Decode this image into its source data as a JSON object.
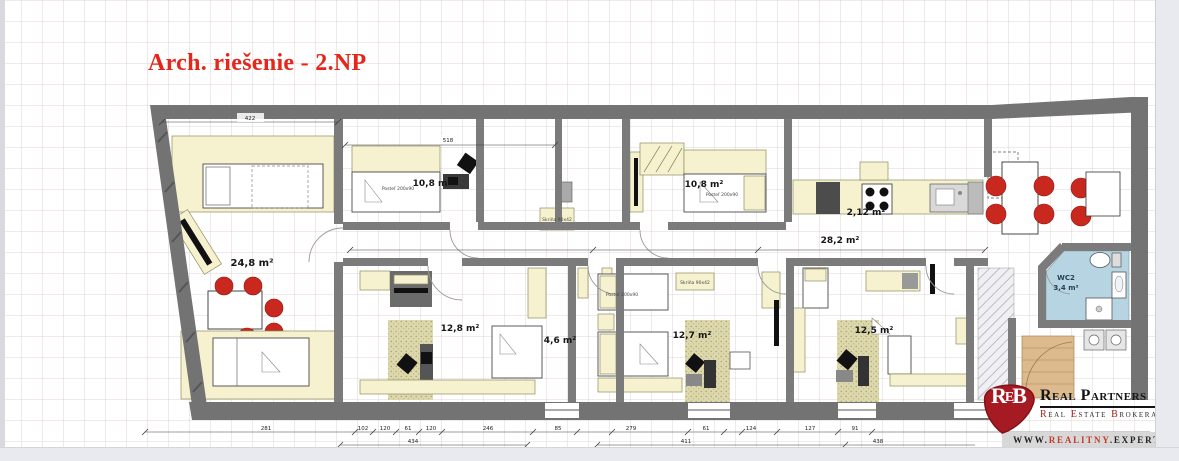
{
  "page": {
    "title": "Arch. riešenie - 2.NP"
  },
  "plan": {
    "rooms": [
      {
        "name": "living-room",
        "label": "24,8 m²"
      },
      {
        "name": "bedroom-1",
        "label": "10,8 m²"
      },
      {
        "name": "bedroom-2",
        "label": "10,8 m²"
      },
      {
        "name": "kitchen",
        "label": "2,12 m²"
      },
      {
        "name": "hall-living",
        "label": "28,2 m²"
      },
      {
        "name": "bedroom-3",
        "label": "12,8 m²"
      },
      {
        "name": "hallway",
        "label": "4,6 m²"
      },
      {
        "name": "bedroom-4",
        "label": "12,7 m²"
      },
      {
        "name": "bedroom-5",
        "label": "12,5 m²"
      },
      {
        "name": "wc2",
        "label": "WC2",
        "area": "3,4 m²"
      }
    ],
    "furniture": {
      "bed_label": "Posteľ 200x90",
      "wardrobe_label": "Skriňa 90x42"
    },
    "dimensions": {
      "top": [
        "422",
        "518"
      ],
      "bottom": [
        "281",
        "102",
        "120",
        "61",
        "120",
        "246",
        "85",
        "279",
        "61",
        "124",
        "127",
        "91"
      ],
      "bottom_lower": [
        "434",
        "411",
        "438"
      ]
    }
  },
  "logo": {
    "mono_r": "R",
    "mono_e": "E",
    "mono_b": "B",
    "name": "Real Partners",
    "tagline_parts": {
      "r": "R",
      "eal": "eal ",
      "e": "E",
      "state": "state ",
      "b": "B",
      "rokerage": "rokerage"
    },
    "website": {
      "prefix": "WWW.",
      "brand": "REALITNY",
      "suffix": ".EXPERT"
    }
  },
  "colors": {
    "title_red": "#e5261b",
    "logo_red": "#a61a23",
    "wall_gray": "#737373",
    "furniture_cream": "#f6f2cf",
    "bathroom_blue": "#b7d4e2",
    "chair_red": "#c9281e",
    "carpet_khaki": "#d8d4a6",
    "stairs_tan": "#dcba8e"
  }
}
